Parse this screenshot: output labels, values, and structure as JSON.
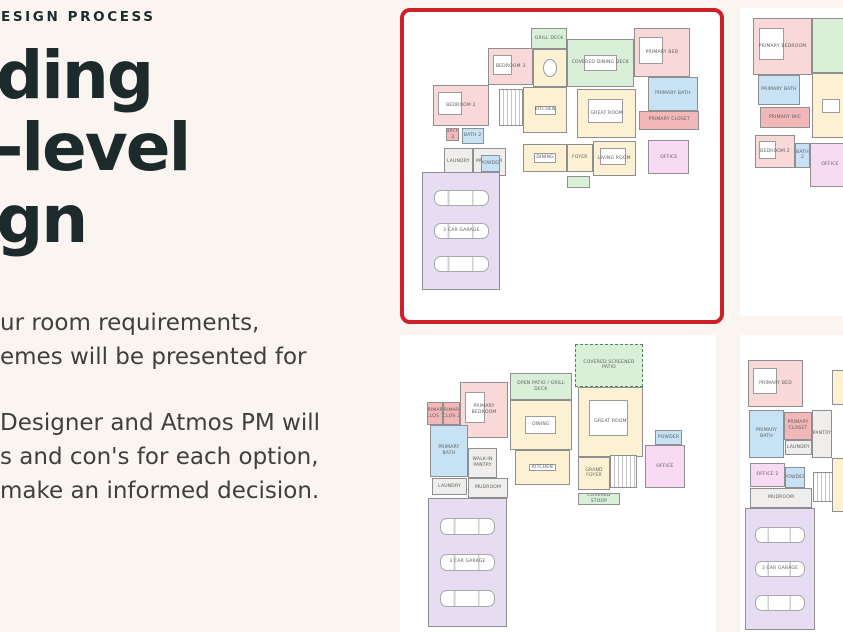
{
  "page": {
    "background": "#faf5f0",
    "card_background": "#ffffff",
    "highlight_border": "#cc2127"
  },
  "hero": {
    "eyebrow": "ESIGN PROCESS",
    "title_lines": [
      "ding",
      "-level",
      "gn"
    ],
    "paragraph1_lines": [
      "ur room requirements,",
      "emes will be presented for"
    ],
    "paragraph2_lines": [
      "Designer and Atmos PM will",
      "s and con's for each option,",
      "make an informed decision."
    ]
  },
  "colors": {
    "rooms": {
      "pink": "#f9d8d8",
      "red": "#f2b7b9",
      "blue": "#c6e2f4",
      "yellow": "#fcf2d3",
      "green": "#d9efd8",
      "purple": "#e7ddf3",
      "magenta": "#f8daf2",
      "gray": "#efeeec",
      "white": "#ffffff"
    },
    "text": {
      "heading": "#1d2a2c",
      "body": "#3f3f3f",
      "room_label": "#5a5a5a"
    }
  },
  "plans": [
    {
      "name": "scheme-1-selected",
      "selected": true,
      "rooms": [
        {
          "label": "GRILL DECK",
          "color": "green",
          "x": 40.3,
          "y": 5.3,
          "w": 11.3,
          "h": 6.7
        },
        {
          "label": "COVERED DINING DECK",
          "color": "green",
          "x": 51.6,
          "y": 8.7,
          "w": 21.1,
          "h": 15.6,
          "furn": "table"
        },
        {
          "label": "BEDROOM 3",
          "color": "pink",
          "x": 26.6,
          "y": 11.7,
          "w": 14.3,
          "h": 12,
          "furn": "bed"
        },
        {
          "label": "",
          "color": "yellow",
          "x": 40.9,
          "y": 12,
          "w": 10.7,
          "h": 12.3,
          "furn": "round"
        },
        {
          "label": "PRIMARY BED",
          "color": "pink",
          "x": 72.7,
          "y": 5.3,
          "w": 17.9,
          "h": 15.7,
          "furn": "bed"
        },
        {
          "label": "PRIMARY BATH",
          "color": "blue",
          "x": 77.3,
          "y": 21,
          "w": 15.6,
          "h": 11
        },
        {
          "label": "PRIMARY CLOSET",
          "color": "red",
          "x": 74.4,
          "y": 32,
          "w": 19.1,
          "h": 6.3
        },
        {
          "label": "BEDROOM 2",
          "color": "pink",
          "x": 9.1,
          "y": 23.7,
          "w": 17.8,
          "h": 13.3,
          "furn": "bed"
        },
        {
          "label": "BATH 3",
          "color": "red",
          "x": 13.3,
          "y": 37.7,
          "w": 4.2,
          "h": 4.3
        },
        {
          "label": "BATH 2",
          "color": "blue",
          "x": 18.2,
          "y": 37.7,
          "w": 7.1,
          "h": 5
        },
        {
          "label": "",
          "color": "white",
          "type": "stairs",
          "x": 30.2,
          "y": 25,
          "w": 7.5,
          "h": 12
        },
        {
          "label": "KITCHEN",
          "color": "yellow",
          "x": 37.7,
          "y": 24.3,
          "w": 13.9,
          "h": 15,
          "furn": "island"
        },
        {
          "label": "GREAT ROOM",
          "color": "yellow",
          "x": 54.9,
          "y": 25,
          "w": 18.5,
          "h": 16,
          "furn": "sofa"
        },
        {
          "label": "DINING",
          "color": "yellow",
          "x": 37.7,
          "y": 42.7,
          "w": 13.9,
          "h": 9.3,
          "furn": "table"
        },
        {
          "label": "FOYER",
          "color": "yellow",
          "x": 51.6,
          "y": 42.7,
          "w": 8.1,
          "h": 9.3
        },
        {
          "label": "LIVING ROOM",
          "color": "yellow",
          "x": 59.7,
          "y": 42,
          "w": 13.7,
          "h": 11.3,
          "furn": "sofa"
        },
        {
          "label": "LAUNDRY",
          "color": "gray",
          "x": 12.7,
          "y": 44.3,
          "w": 9,
          "h": 9
        },
        {
          "label": "MUDROOM",
          "color": "gray",
          "x": 21.7,
          "y": 44.3,
          "w": 10.5,
          "h": 9
        },
        {
          "label": "POWDER",
          "color": "blue",
          "x": 24.5,
          "y": 46.5,
          "w": 6,
          "h": 5.5
        },
        {
          "label": "OFFICE",
          "color": "magenta",
          "x": 77.3,
          "y": 41.7,
          "w": 13,
          "h": 11
        },
        {
          "label": "3 CAR GARAGE",
          "color": "purple",
          "type": "garage",
          "x": 5.8,
          "y": 52,
          "w": 24.7,
          "h": 38.3
        },
        {
          "label": "",
          "color": "green",
          "x": 51.6,
          "y": 53.3,
          "w": 7.2,
          "h": 3.7
        }
      ]
    },
    {
      "name": "scheme-2",
      "selected": false,
      "rooms": [
        {
          "label": "PRIMARY BEDROOM",
          "color": "pink",
          "x": 11.8,
          "y": 3.2,
          "w": 53.7,
          "h": 18.6,
          "furn": "bed"
        },
        {
          "label": "",
          "color": "green",
          "x": 65.5,
          "y": 3.2,
          "w": 34.5,
          "h": 17.9
        },
        {
          "label": "PRIMARY BATH",
          "color": "blue",
          "x": 16.4,
          "y": 21.8,
          "w": 38.1,
          "h": 9.7
        },
        {
          "label": "PRIMARY WIC",
          "color": "red",
          "x": 18.2,
          "y": 32.1,
          "w": 45.4,
          "h": 6.9
        },
        {
          "label": "",
          "color": "yellow",
          "x": 65.5,
          "y": 21.1,
          "w": 34.5,
          "h": 21.1,
          "furn": "island"
        },
        {
          "label": "BEDROOM 2",
          "color": "pink",
          "x": 13.6,
          "y": 41.2,
          "w": 36.4,
          "h": 10.7,
          "furn": "bed"
        },
        {
          "label": "BATH 2",
          "color": "blue",
          "x": 50,
          "y": 43.8,
          "w": 13.6,
          "h": 8.1
        },
        {
          "label": "OFFICE",
          "color": "magenta",
          "x": 63.6,
          "y": 43.8,
          "w": 36.4,
          "h": 14.3
        }
      ]
    },
    {
      "name": "scheme-3",
      "selected": false,
      "rooms": [
        {
          "label": "COVERED SCREENED PATIO",
          "color": "green",
          "dashed": true,
          "x": 55.5,
          "y": 1.7,
          "w": 22.1,
          "h": 14.9
        },
        {
          "label": "OPEN PATIO / GRILL DECK",
          "color": "green",
          "x": 34.4,
          "y": 11.8,
          "w": 20.1,
          "h": 9.3
        },
        {
          "label": "PRIMARY BEDROOM",
          "color": "pink",
          "x": 18.2,
          "y": 14.9,
          "w": 15.6,
          "h": 19.4,
          "furn": "bed"
        },
        {
          "label": "PRIMARY CLOS 1",
          "color": "red",
          "x": 7.5,
          "y": 21.8,
          "w": 5.2,
          "h": 8
        },
        {
          "label": "PRIMARY CLOS 2",
          "color": "red",
          "x": 12.7,
          "y": 21.8,
          "w": 5.5,
          "h": 8
        },
        {
          "label": "PRIMARY BATH",
          "color": "blue",
          "x": 8.4,
          "y": 29.8,
          "w": 12.4,
          "h": 18
        },
        {
          "label": "WALK-IN PANTRY",
          "color": "gray",
          "x": 20.8,
          "y": 37.7,
          "w": 9.4,
          "h": 10.4
        },
        {
          "label": "DINING",
          "color": "yellow",
          "x": 34.4,
          "y": 21.1,
          "w": 20.1,
          "h": 17.3,
          "furn": "table"
        },
        {
          "label": "KITCHEN",
          "color": "yellow",
          "x": 36,
          "y": 38.4,
          "w": 17.9,
          "h": 12.1,
          "furn": "island"
        },
        {
          "label": "GREAT ROOM",
          "color": "yellow",
          "x": 56.5,
          "y": 16.6,
          "w": 21.1,
          "h": 24.2,
          "furn": "sofa"
        },
        {
          "label": "GRAND FOYER",
          "color": "yellow",
          "x": 56.5,
          "y": 40.8,
          "w": 10.4,
          "h": 11.4
        },
        {
          "label": "",
          "color": "white",
          "type": "stairs",
          "x": 66.9,
          "y": 40.1,
          "w": 8.7,
          "h": 11.5
        },
        {
          "label": "POWDER",
          "color": "blue",
          "x": 81.5,
          "y": 31.5,
          "w": 8.8,
          "h": 5.2
        },
        {
          "label": "OFFICE",
          "color": "magenta",
          "x": 78.2,
          "y": 36.7,
          "w": 13,
          "h": 14.9
        },
        {
          "label": "LAUNDRY",
          "color": "gray",
          "x": 9.1,
          "y": 48.1,
          "w": 11.4,
          "h": 5.9
        },
        {
          "label": "MUDROOM",
          "color": "gray",
          "x": 20.8,
          "y": 48.1,
          "w": 13,
          "h": 6.9
        },
        {
          "label": "3 CAR GARAGE",
          "color": "purple",
          "type": "garage",
          "x": 7.8,
          "y": 55,
          "w": 25.6,
          "h": 44.5
        },
        {
          "label": "COVERED STOOP",
          "color": "green",
          "x": 56.5,
          "y": 53.3,
          "w": 13.6,
          "h": 4.1
        }
      ]
    },
    {
      "name": "scheme-4",
      "selected": false,
      "rooms": [
        {
          "label": "PRIMARY BED",
          "color": "pink",
          "x": 7.3,
          "y": 8.4,
          "w": 50,
          "h": 15.8,
          "furn": "bed"
        },
        {
          "label": "",
          "color": "yellow",
          "x": 83.6,
          "y": 11.8,
          "w": 16.4,
          "h": 11.8
        },
        {
          "label": "PRIMARY BATH",
          "color": "blue",
          "x": 8.2,
          "y": 25.3,
          "w": 31.8,
          "h": 16.1
        },
        {
          "label": "PRIMARY CLOSET",
          "color": "red",
          "x": 40,
          "y": 25.9,
          "w": 25.5,
          "h": 9.5
        },
        {
          "label": "LAUNDRY",
          "color": "gray",
          "x": 40.9,
          "y": 35.4,
          "w": 24.6,
          "h": 5
        },
        {
          "label": "PANTRY",
          "color": "gray",
          "x": 65.5,
          "y": 25.3,
          "w": 18.1,
          "h": 16.1
        },
        {
          "label": "OFFICE 2",
          "color": "magenta",
          "x": 9.1,
          "y": 43.1,
          "w": 31.8,
          "h": 8.1
        },
        {
          "label": "POWDER",
          "color": "blue",
          "x": 40.9,
          "y": 44.4,
          "w": 18.2,
          "h": 7.1
        },
        {
          "label": "MUDROOM",
          "color": "gray",
          "x": 9.1,
          "y": 51.5,
          "w": 56.4,
          "h": 6.7
        },
        {
          "label": "",
          "color": "white",
          "type": "stairs",
          "x": 66.4,
          "y": 46.1,
          "w": 22.7,
          "h": 10.1
        },
        {
          "label": "",
          "color": "yellow",
          "x": 83.6,
          "y": 41.4,
          "w": 16.4,
          "h": 18.2
        },
        {
          "label": "3 CAR GARAGE",
          "color": "purple",
          "type": "garage",
          "x": 4.5,
          "y": 58.2,
          "w": 63.7,
          "h": 41.1
        }
      ]
    }
  ]
}
